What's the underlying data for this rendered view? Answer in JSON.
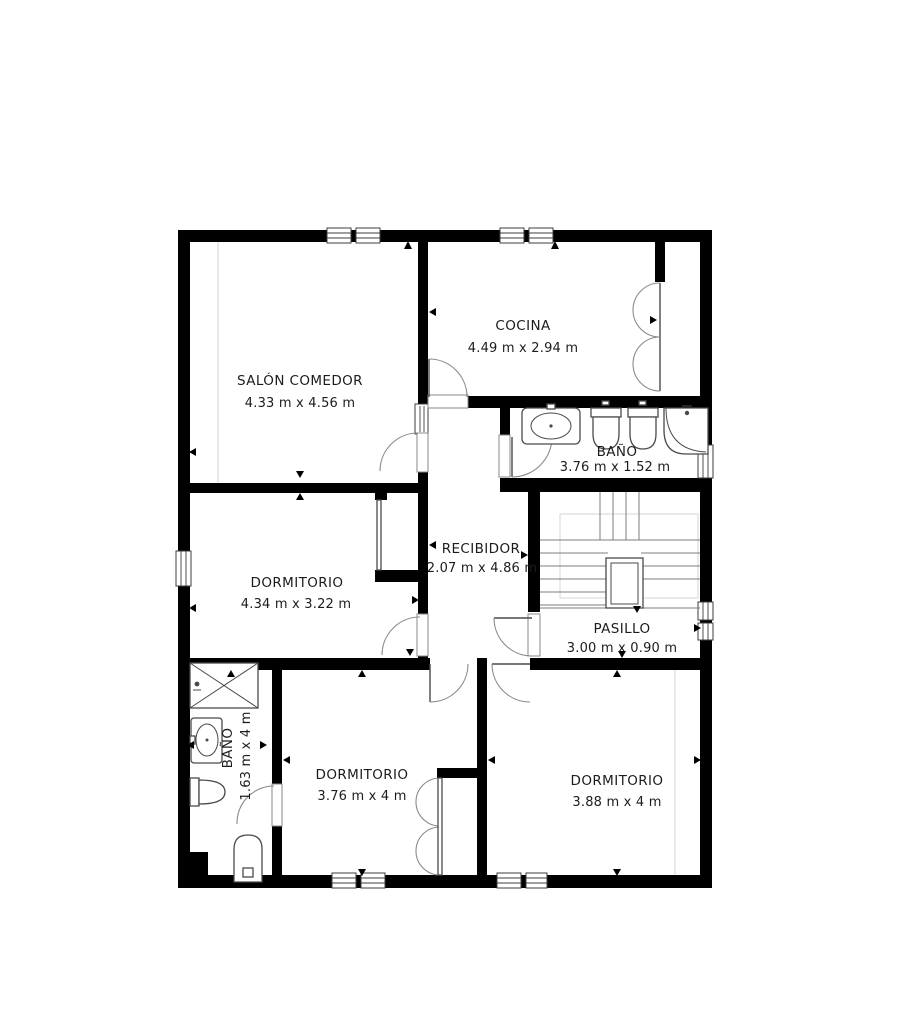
{
  "plan": {
    "type": "floor-plan",
    "language": "es",
    "rooms": [
      {
        "id": "salon",
        "name": "SALÓN COMEDOR",
        "dims": "4.33 m x 4.56 m"
      },
      {
        "id": "cocina",
        "name": "COCINA",
        "dims": "4.49 m x 2.94 m"
      },
      {
        "id": "bano-superior",
        "name": "BAÑO",
        "dims": "3.76 m x 1.52 m"
      },
      {
        "id": "dormitorio-1",
        "name": "DORMITORIO",
        "dims": "4.34 m x 3.22 m"
      },
      {
        "id": "recibidor",
        "name": "RECIBIDOR",
        "dims": "2.07 m x 4.86 m"
      },
      {
        "id": "pasillo",
        "name": "PASILLO",
        "dims": "3.00 m x 0.90 m"
      },
      {
        "id": "bano-inferior",
        "name": "BAÑO",
        "dims": "1.63 m x 4 m"
      },
      {
        "id": "dormitorio-2",
        "name": "DORMITORIO",
        "dims": "3.76 m x 4 m"
      },
      {
        "id": "dormitorio-3",
        "name": "DORMITORIO",
        "dims": "3.88 m x 4 m"
      }
    ],
    "symbols": [
      "door-swing",
      "bifold-door",
      "window",
      "staircase",
      "sink",
      "toilet",
      "bidet",
      "shower"
    ],
    "colors": {
      "wall": "#000000",
      "background": "#ffffff",
      "fixture_stroke": "#4a4a4a",
      "door_arc": "#8a8a8a",
      "text": "#1c1c1c"
    }
  }
}
